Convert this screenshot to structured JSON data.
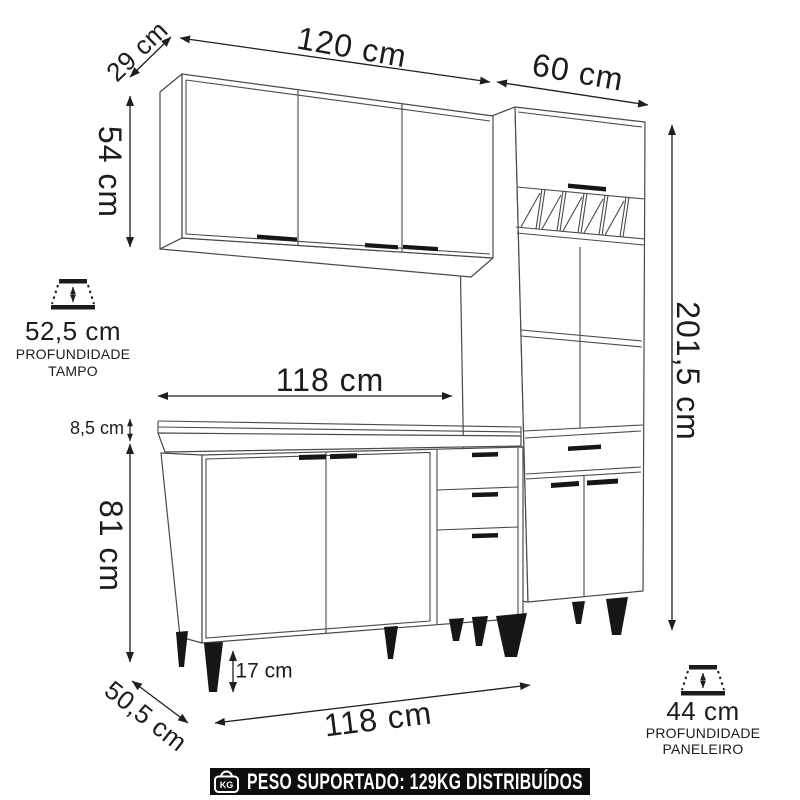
{
  "page": {
    "background": "#ffffff",
    "line_color": "#4a4a4a",
    "dimension_color": "#1f1f1f",
    "banner_bg": "#0e0e0e",
    "banner_text_color": "#ffffff"
  },
  "annotations": {
    "wall_cabinet_depth": "29 cm",
    "wall_cabinet_width": "120 cm",
    "tall_cabinet_width": "60 cm",
    "wall_cabinet_height": "54 cm",
    "countertop_depth": "52,5 cm",
    "countertop_depth_caption_line1": "PROFUNDIDADE",
    "countertop_depth_caption_line2": "TAMPO",
    "base_width_top": "118 cm",
    "countertop_thickness": "8,5 cm",
    "base_cabinet_height": "81 cm",
    "feet_height": "17 cm",
    "base_cabinet_depth": "50,5 cm",
    "base_width_bottom": "118 cm",
    "tall_cabinet_height": "201,5 cm",
    "tall_cabinet_depth": "44 cm",
    "tall_cabinet_depth_caption_line1": "PROFUNDIDADE",
    "tall_cabinet_depth_caption_line2": "PANELEIRO"
  },
  "footer": {
    "weight_icon_label": "KG",
    "support_text": "PESO SUPORTADO: 129KG DISTRIBUÍDOS"
  }
}
